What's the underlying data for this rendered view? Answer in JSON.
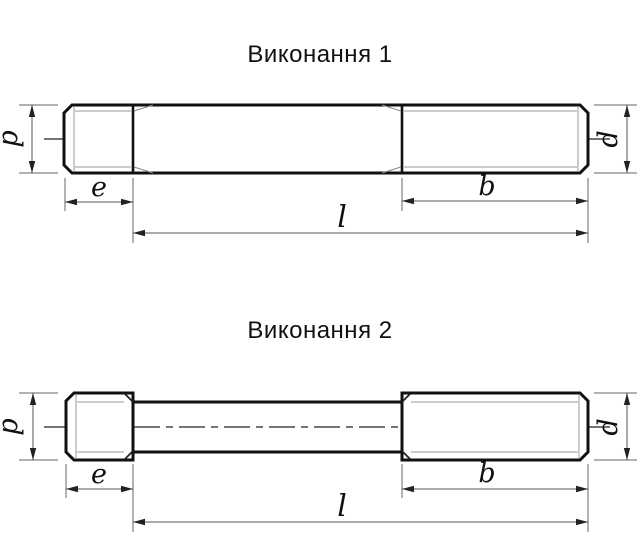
{
  "page": {
    "background": "#ffffff",
    "outline_color": "#111111",
    "thin_line_color": "#999999",
    "dimension_line_color": "#555555",
    "text_color": "#111111"
  },
  "drawing1": {
    "title": "Виконання 1",
    "labels": {
      "d_left": "d",
      "d_right": "d",
      "e": "e",
      "b": "b",
      "l": "l"
    }
  },
  "drawing2": {
    "title": "Виконання 2",
    "labels": {
      "d_left": "d",
      "d_right": "d",
      "e": "e",
      "b": "b",
      "l": "l"
    }
  }
}
